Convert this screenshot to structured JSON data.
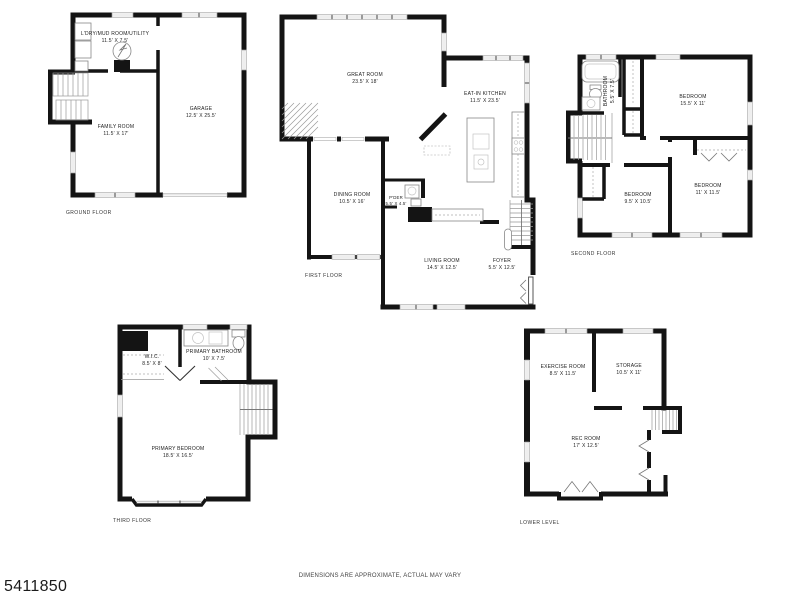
{
  "footer": {
    "watermark": "5411850",
    "disclaimer": "DIMENSIONS ARE APPROXIMATE, ACTUAL MAY VARY"
  },
  "colors": {
    "wall": "#141414",
    "background": "#ffffff",
    "text": "#222222"
  },
  "floors": [
    {
      "label": "GROUND FLOOR",
      "rooms": [
        {
          "name": "L'DRY/MUD ROOM/UTILITY",
          "dims": "11.5' X 7.5'"
        },
        {
          "name": "FAMILY ROOM",
          "dims": "11.5' X 17'"
        },
        {
          "name": "GARAGE",
          "dims": "12.5' X 25.5'"
        }
      ]
    },
    {
      "label": "FIRST FLOOR",
      "rooms": [
        {
          "name": "GREAT ROOM",
          "dims": "23.5' X 18'"
        },
        {
          "name": "EAT-IN KITCHEN",
          "dims": "11.5' X 23.5'"
        },
        {
          "name": "DINING ROOM",
          "dims": "10.5' X 16'"
        },
        {
          "name": "P'DER",
          "dims": "5.5' X 4.5'"
        },
        {
          "name": "LIVING ROOM",
          "dims": "14.5' X 12.5'"
        },
        {
          "name": "FOYER",
          "dims": "5.5' X 12.5'"
        }
      ]
    },
    {
      "label": "SECOND FLOOR",
      "rooms": [
        {
          "name": "BATHROOM",
          "dims": "5.5' X 7.5'"
        },
        {
          "name": "BEDROOM",
          "dims": "15.5' X 11'"
        },
        {
          "name": "BEDROOM",
          "dims": "9.5' X 10.5'"
        },
        {
          "name": "BEDROOM",
          "dims": "11' X 11.5'"
        }
      ]
    },
    {
      "label": "THIRD FLOOR",
      "rooms": [
        {
          "name": "W.I.C.",
          "dims": "8.5' X 8'"
        },
        {
          "name": "PRIMARY BATHROOM",
          "dims": "10' X 7.5'"
        },
        {
          "name": "PRIMARY BEDROOM",
          "dims": "18.5' X 16.5'"
        }
      ]
    },
    {
      "label": "LOWER LEVEL",
      "rooms": [
        {
          "name": "EXERCISE ROOM",
          "dims": "8.5' X 11.5'"
        },
        {
          "name": "STORAGE",
          "dims": "10.5' X 11'"
        },
        {
          "name": "REC ROOM",
          "dims": "17' X 12.5'"
        }
      ]
    }
  ]
}
